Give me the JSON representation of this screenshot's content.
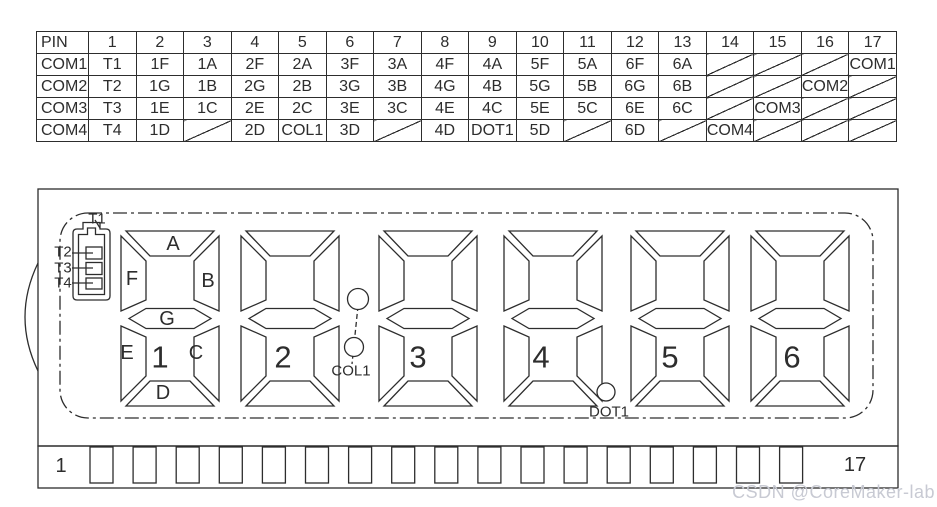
{
  "pin_table": {
    "corner_label": "PIN",
    "pins": [
      "1",
      "2",
      "3",
      "4",
      "5",
      "6",
      "7",
      "8",
      "9",
      "10",
      "11",
      "12",
      "13",
      "14",
      "15",
      "16",
      "17"
    ],
    "rows": [
      {
        "label": "COM1",
        "cells": [
          "T1",
          "1F",
          "1A",
          "2F",
          "2A",
          "3F",
          "3A",
          "4F",
          "4A",
          "5F",
          "5A",
          "6F",
          "6A",
          "/",
          "/",
          "/",
          "COM1"
        ]
      },
      {
        "label": "COM2",
        "cells": [
          "T2",
          "1G",
          "1B",
          "2G",
          "2B",
          "3G",
          "3B",
          "4G",
          "4B",
          "5G",
          "5B",
          "6G",
          "6B",
          "/",
          "/",
          "COM2",
          "/"
        ]
      },
      {
        "label": "COM3",
        "cells": [
          "T3",
          "1E",
          "1C",
          "2E",
          "2C",
          "3E",
          "3C",
          "4E",
          "4C",
          "5E",
          "5C",
          "6E",
          "6C",
          "/",
          "COM3",
          "/",
          "/"
        ]
      },
      {
        "label": "COM4",
        "cells": [
          "T4",
          "1D",
          "/",
          "2D",
          "COL1",
          "3D",
          "/",
          "4D",
          "DOT1",
          "5D",
          "/",
          "6D",
          "/",
          "COM4",
          "/",
          "/",
          "/"
        ]
      }
    ]
  },
  "display": {
    "battery_labels": {
      "t1": "T1",
      "t2": "T2",
      "t3": "T3",
      "t4": "T4"
    },
    "segment_labels": {
      "a": "A",
      "b": "B",
      "c": "C",
      "d": "D",
      "e": "E",
      "f": "F",
      "g": "G"
    },
    "digit_labels": [
      "1",
      "2",
      "3",
      "4",
      "5",
      "6"
    ],
    "colon_label": "COL1",
    "dot_label": "DOT1"
  },
  "pin_strip": {
    "pin_count": 17,
    "first_pin_label": "1",
    "last_pin_label": "17"
  },
  "watermark": "CSDN @CoreMaker-lab",
  "colors": {
    "line": "#2d2d2d",
    "watermark": "#c8cad3"
  }
}
